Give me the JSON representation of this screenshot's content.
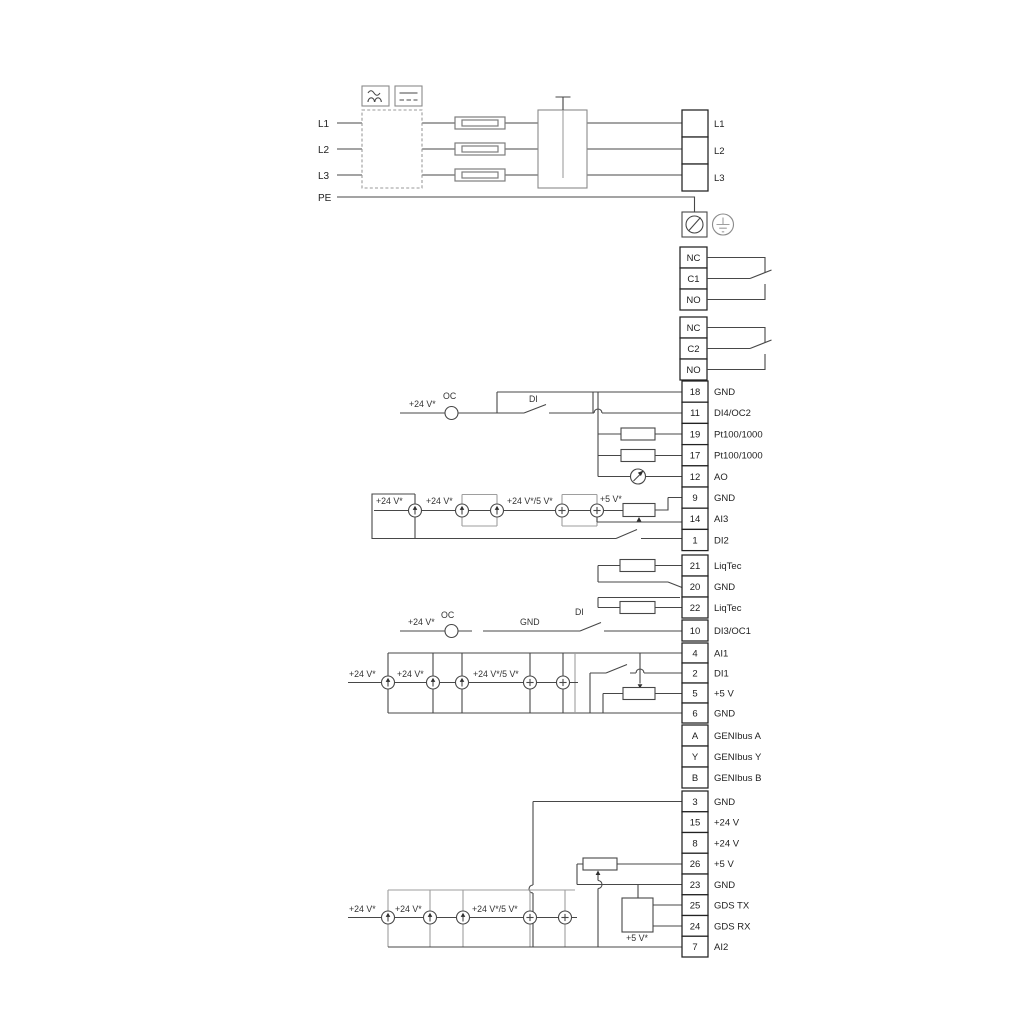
{
  "rail": {
    "l1": "L1",
    "l2": "L2",
    "l3": "L3",
    "pe": "PE"
  },
  "blocks": {
    "mains": [
      {
        "label": "L1"
      },
      {
        "label": "L2"
      },
      {
        "label": "L3"
      }
    ],
    "relay1": [
      {
        "num": "NC"
      },
      {
        "num": "C1"
      },
      {
        "num": "NO"
      }
    ],
    "relay2": [
      {
        "num": "NC"
      },
      {
        "num": "C2"
      },
      {
        "num": "NO"
      }
    ],
    "io_top": [
      {
        "num": "18",
        "label": "GND"
      },
      {
        "num": "11",
        "label": "DI4/OC2"
      },
      {
        "num": "19",
        "label": "Pt100/1000"
      },
      {
        "num": "17",
        "label": "Pt100/1000"
      },
      {
        "num": "12",
        "label": "AO"
      },
      {
        "num": "9",
        "label": "GND"
      },
      {
        "num": "14",
        "label": "AI3"
      },
      {
        "num": "1",
        "label": "DI2"
      }
    ],
    "liqtec": [
      {
        "num": "21",
        "label": "LiqTec"
      },
      {
        "num": "20",
        "label": "GND"
      },
      {
        "num": "22",
        "label": "LiqTec"
      }
    ],
    "di3": [
      {
        "num": "10",
        "label": "DI3/OC1"
      }
    ],
    "ai1": [
      {
        "num": "4",
        "label": "AI1"
      },
      {
        "num": "2",
        "label": "DI1"
      },
      {
        "num": "5",
        "label": "+5 V"
      },
      {
        "num": "6",
        "label": "GND"
      }
    ],
    "genibus": [
      {
        "num": "A",
        "label": "GENIbus A"
      },
      {
        "num": "Y",
        "label": "GENIbus Y"
      },
      {
        "num": "B",
        "label": "GENIbus B"
      }
    ],
    "io_bottom": [
      {
        "num": "3",
        "label": "GND"
      },
      {
        "num": "15",
        "label": "+24 V"
      },
      {
        "num": "8",
        "label": "+24 V"
      },
      {
        "num": "26",
        "label": "+5 V"
      },
      {
        "num": "23",
        "label": "GND"
      },
      {
        "num": "25",
        "label": "GDS TX"
      },
      {
        "num": "24",
        "label": "GDS RX"
      },
      {
        "num": "7",
        "label": "AI2"
      }
    ]
  },
  "ann": {
    "oc2": {
      "v24": "+24 V*",
      "oc": "OC",
      "di": "DI"
    },
    "oc1": {
      "v24": "+24 V*",
      "oc": "OC",
      "gnd": "GND",
      "di": "DI"
    },
    "ai3": {
      "a": "+24 V*",
      "b": "+24 V*",
      "c": "+24 V*/5 V*",
      "d": "+5 V*"
    },
    "ai1": {
      "a": "+24 V*",
      "b": "+24 V*",
      "c": "+24 V*/5 V*"
    },
    "ai2": {
      "a": "+24 V*",
      "b": "+24 V*",
      "c": "+24 V*/5 V*",
      "d": "+5 V*"
    }
  },
  "colors": {
    "wire": "#474747",
    "grey": "#9e9e9e",
    "terminal_border": "#222222"
  }
}
